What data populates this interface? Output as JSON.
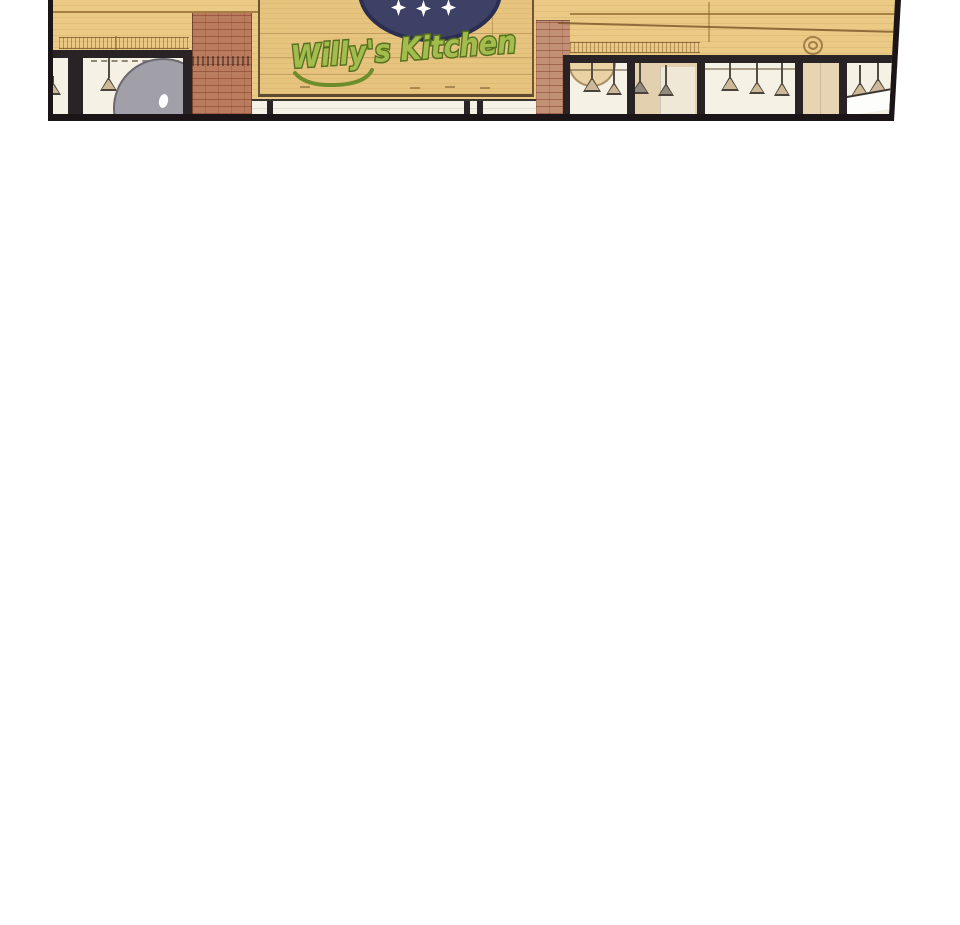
{
  "page": {
    "background_color": "#ffffff"
  },
  "panel": {
    "kind": "comic-panel",
    "scene_description": "restaurant storefront exterior",
    "border_color": "#1b1517",
    "wall_color": "#ebca86",
    "sign": {
      "text": "Willy's Kitchen",
      "text_fill_color": "#a3bc4e",
      "text_outline_color": "#55711f",
      "board_color": "#e6c47e",
      "emblem": {
        "shape": "oval",
        "fill_color": "#3e4166",
        "outline_color": "#2b2e50",
        "star_count": 3,
        "star_color": "#ffffff"
      }
    },
    "bricks": {
      "left_column_color": "#b97c5e",
      "right_column_color": "#c29175"
    },
    "windows": {
      "pane_color": "#f6f1e5",
      "frame_color": "#2a2326",
      "pendant_lamp_count": 12,
      "lamp_shade_color": "#cdb997"
    }
  }
}
